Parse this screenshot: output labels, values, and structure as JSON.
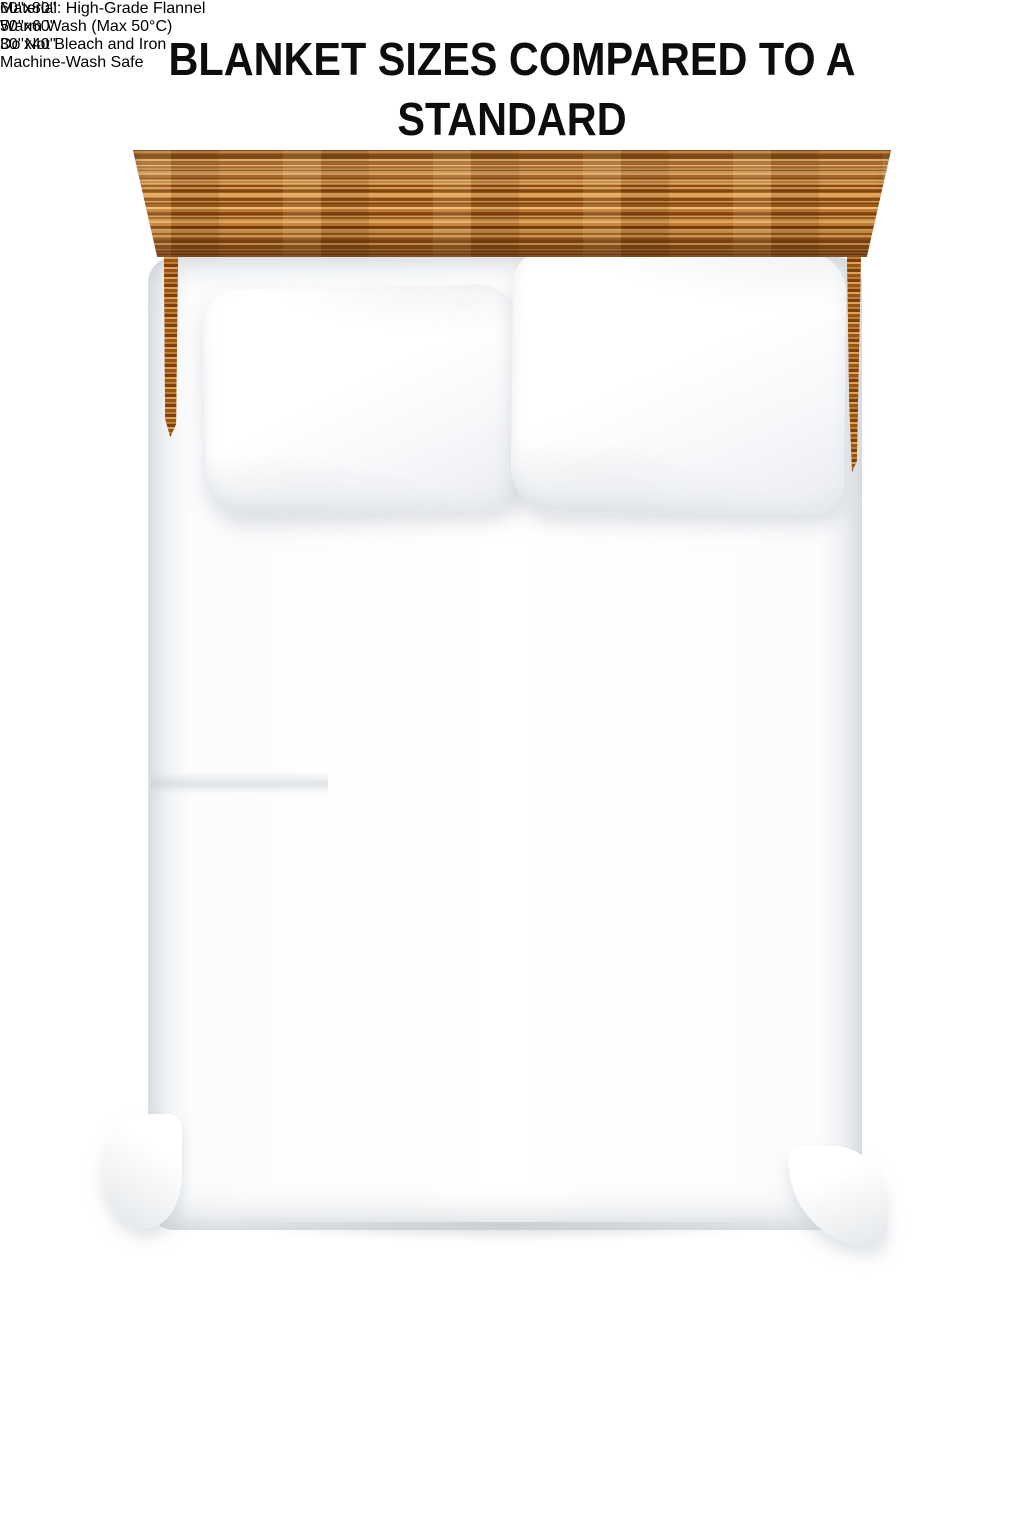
{
  "title": {
    "line1": "BLANKET SIZES COMPARED TO A STANDARD",
    "line2": "QUEEN SIZE BED"
  },
  "diagram": {
    "bed_description": "top view of a standard queen size bed with wooden headboard and two white pillows",
    "blankets": [
      {
        "id": "large",
        "size_label": "60''x80''",
        "outline": "dashed",
        "visible_edges": [
          "top",
          "left"
        ]
      },
      {
        "id": "medium",
        "size_label": "50''x60''",
        "outline": "dashed",
        "visible_edges": [
          "top",
          "right"
        ],
        "fill": "gray fleece blanket"
      },
      {
        "id": "small",
        "size_label": "30''x40''",
        "outline": "dashed",
        "visible_edges": [
          "left",
          "bottom"
        ],
        "fill": "tan fleece blanket"
      }
    ]
  },
  "care_instructions": [
    "Material: High-Grade Flannel",
    "Warm Wash (Max 50°C)",
    "Do Not Bleach and Iron",
    "Machine-Wash Safe"
  ],
  "colors": {
    "background": "#ffffff",
    "text": "#0d0d0d",
    "dash_outline": "#0c0c0c",
    "wood": "#b06c2a",
    "wood_dark": "#8a4a12",
    "wood_light": "#e3a65d",
    "gray_blanket": "#c6c9cb",
    "tan_blanket": "#ecd8ac",
    "bed_white": "#ffffff",
    "bed_shadow": "#c9ced3"
  }
}
